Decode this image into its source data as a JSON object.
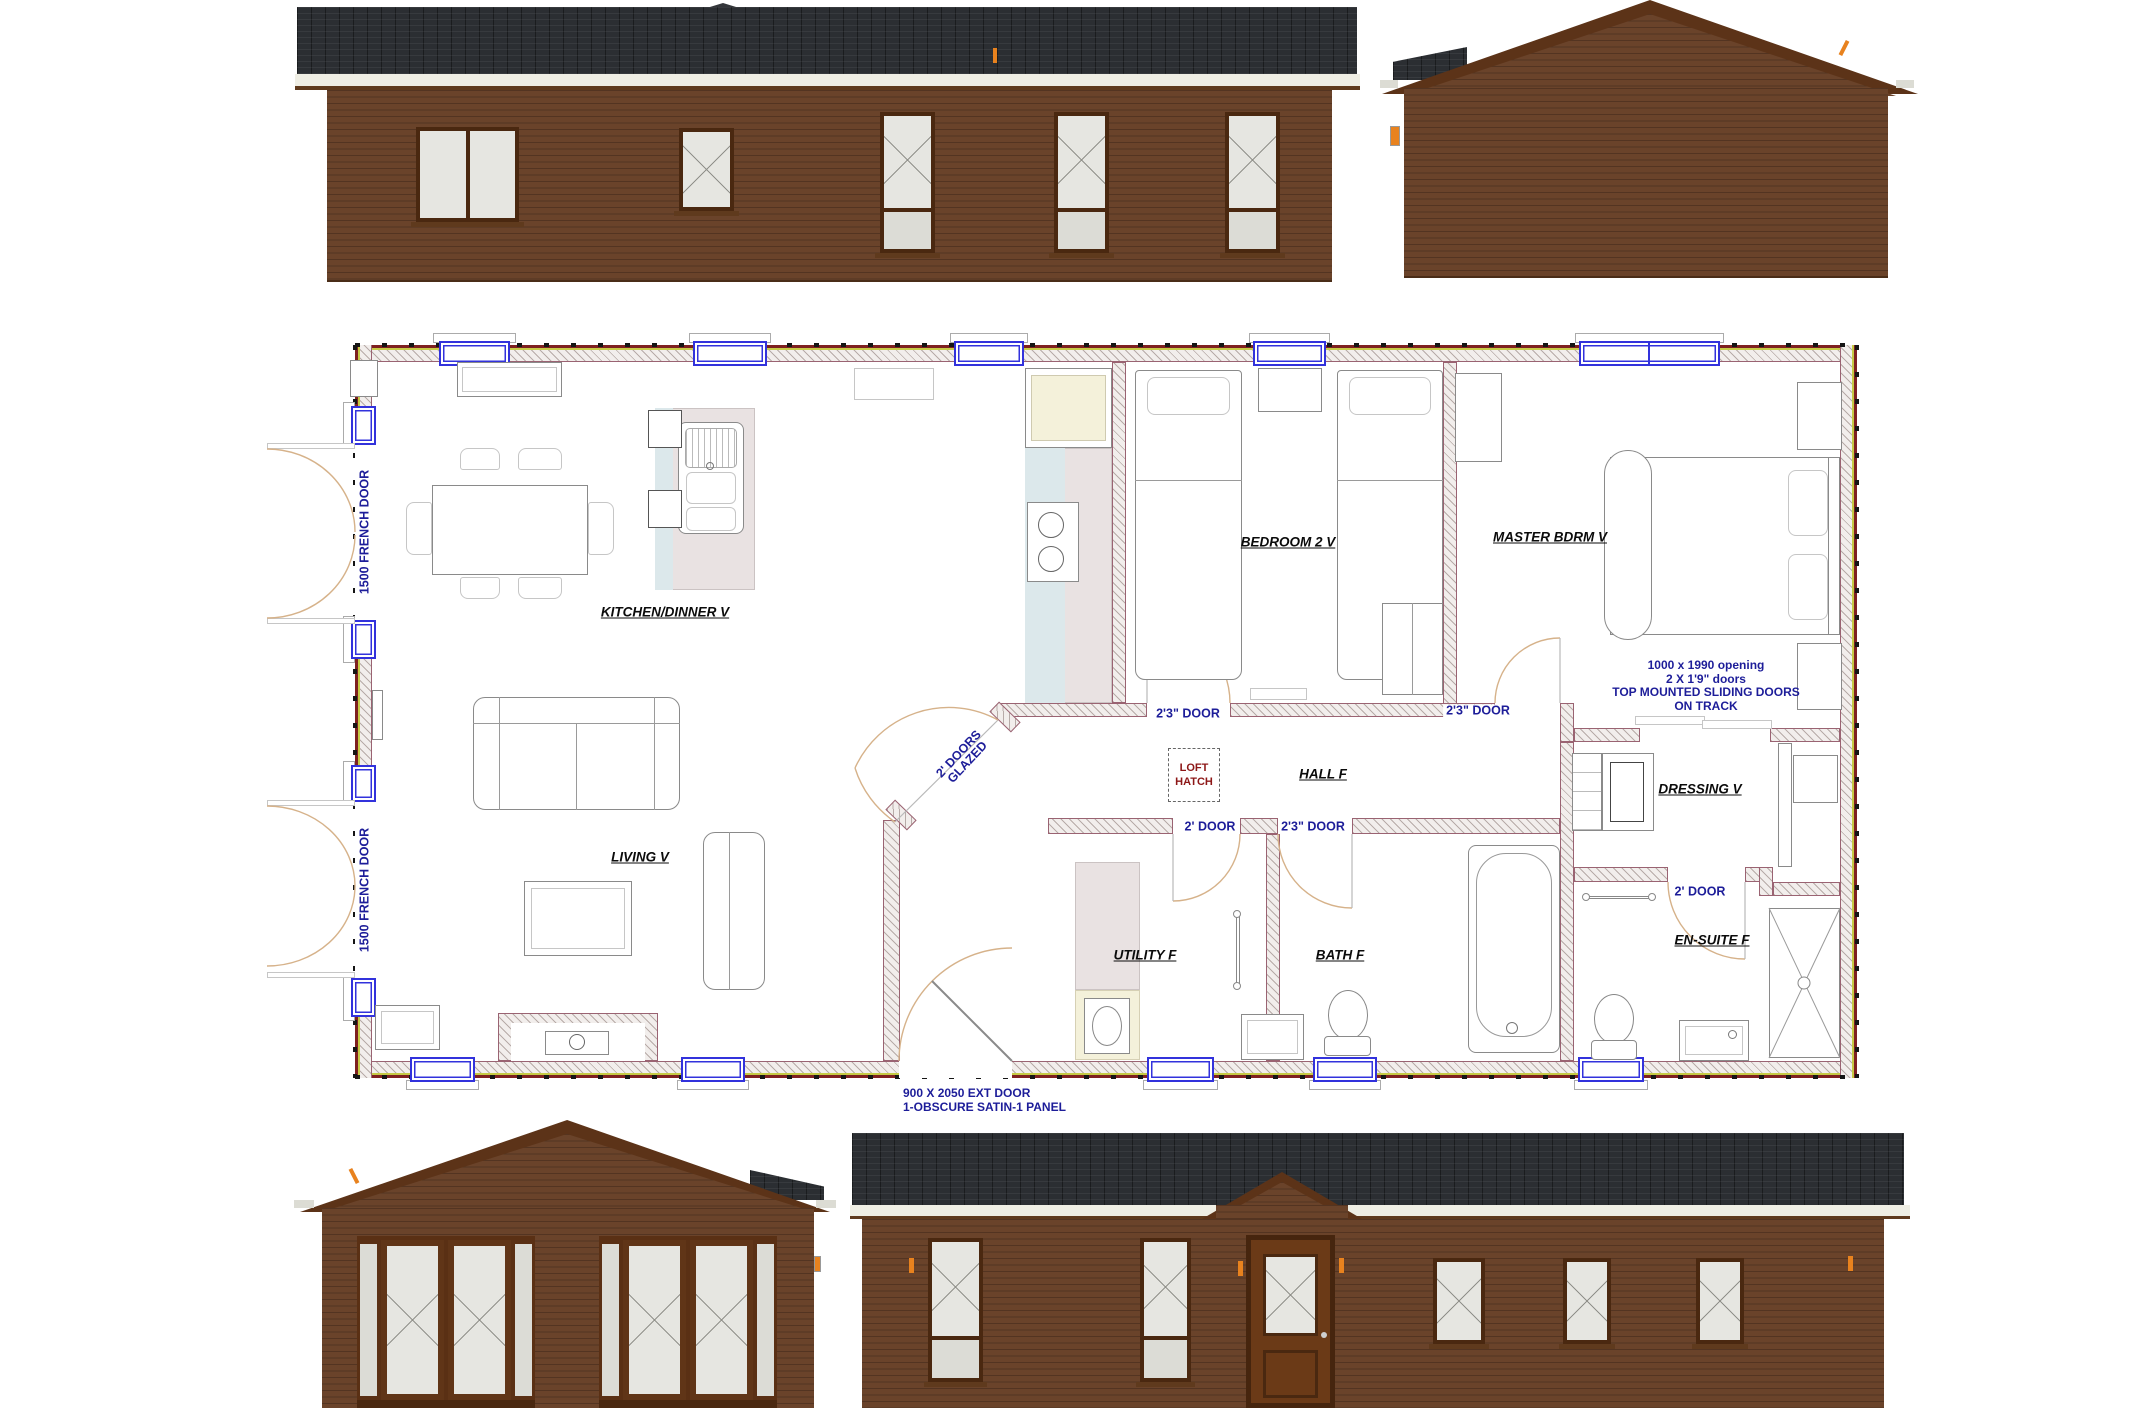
{
  "title": "Lodge floor plan with four elevations",
  "colors": {
    "elevation_wall_brown": "#6a432a",
    "roof_dark": "#2b2e32",
    "gable_fascia_brown": "#5c3318",
    "plan_window_blue": "#3232dc",
    "plan_wall_outer_red": "#7e2020",
    "plan_wall_yellow": "#c6ca45",
    "label_navy": "#1d1d99",
    "loft_hatch_red": "#8d1717",
    "door_swing_tan": "#d6b28a",
    "accent_orange": "#e8821e"
  },
  "plan": {
    "rooms": {
      "kitchen": "KITCHEN/DINNER V",
      "living": "LIVING V",
      "bedroom2": "BEDROOM 2 V",
      "master": "MASTER BDRM V",
      "hall": "HALL F",
      "dressing": "DRESSING V",
      "utility": "UTILITY F",
      "bath": "BATH F",
      "ensuite": "EN-SUITE F"
    },
    "doors": {
      "french_top": "1500 FRENCH DOOR",
      "french_bottom": "1500 FRENCH DOOR",
      "bedroom2": "2'3\" DOOR",
      "master": "2'3\" DOOR",
      "utility": "2' DOOR",
      "bath": "2'3\" DOOR",
      "ensuite": "2' DOOR",
      "glazed_line1": "2' DOORS",
      "glazed_line2": "GLAZED"
    },
    "loft_hatch": {
      "line1": "LOFT",
      "line2": "HATCH"
    },
    "annotations": {
      "sliding1": "1000 x 1990 opening",
      "sliding2": "2 X 1'9\" doors",
      "sliding3": "TOP MOUNTED SLIDING DOORS",
      "sliding4": "ON TRACK",
      "extdoor1": "900 X 2050 EXT DOOR",
      "extdoor2": "1-OBSCURE SATIN-1 PANEL"
    }
  }
}
